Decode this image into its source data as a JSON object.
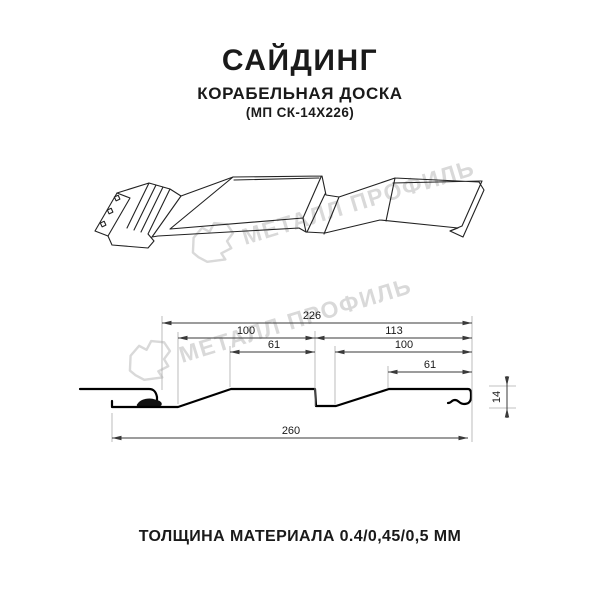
{
  "header": {
    "title": "САЙДИНГ",
    "subtitle": "КОРАБЕЛЬНАЯ ДОСКА",
    "model": "(МП СК-14Х226)"
  },
  "watermark": {
    "text": "МЕТАЛЛ ПРОФИЛЬ",
    "color": "#d9d9d9"
  },
  "drawing": {
    "views": [
      "3d-perspective-profile",
      "cross-section-with-dimensions"
    ],
    "line_color": "#1a1a1a",
    "dimension_line_color": "#3a3a3a",
    "extension_line_color": "#ababab",
    "dimensions": {
      "cover_width": "226",
      "board1_width": "100",
      "board1_flat": "61",
      "board2_width": "113",
      "board2_inner_width": "100",
      "board2_flat": "61",
      "overall_width": "260",
      "profile_height": "14"
    }
  },
  "footer": {
    "text": "ТОЛЩИНА МАТЕРИАЛА 0.4/0,45/0,5 ММ"
  }
}
